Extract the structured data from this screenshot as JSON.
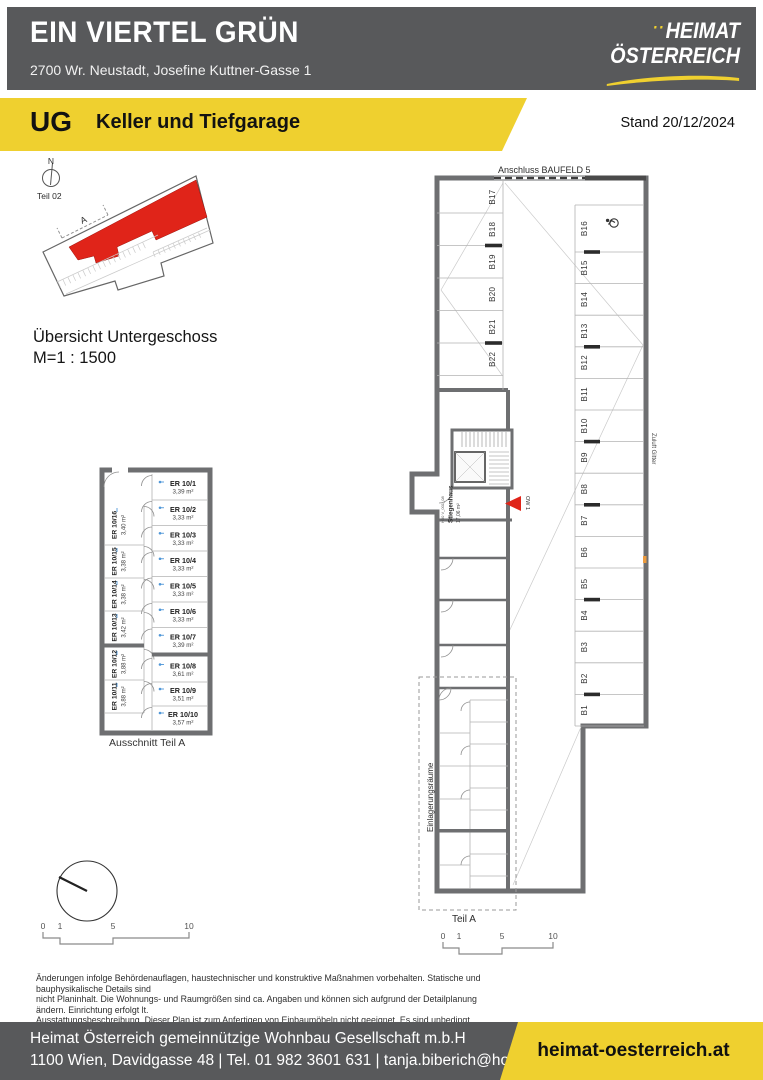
{
  "header": {
    "title": "EIN VIERTEL GRÜN",
    "address": "2700 Wr. Neustadt, Josefine Kuttner-Gasse 1",
    "logo": {
      "dots": "··",
      "line1": "HEIMAT",
      "line2": "ÖSTERREICH"
    }
  },
  "banner": {
    "level": "UG",
    "title": "Keller und Tiefgarage",
    "stand": "Stand 20/12/2024"
  },
  "overview": {
    "north": "N",
    "part": "Teil 02",
    "marker": "A",
    "caption1": "Übersicht Untergeschoss",
    "caption2": "M=1 : 1500"
  },
  "detail": {
    "caption": "Ausschnitt Teil A",
    "rooms_right": [
      {
        "id": "ER 10/1",
        "area": "3,39 m²"
      },
      {
        "id": "ER 10/2",
        "area": "3,33 m²"
      },
      {
        "id": "ER 10/3",
        "area": "3,33 m²"
      },
      {
        "id": "ER 10/4",
        "area": "3,33 m²"
      },
      {
        "id": "ER 10/5",
        "area": "3,33 m²"
      },
      {
        "id": "ER 10/6",
        "area": "3,33 m²"
      },
      {
        "id": "ER 10/7",
        "area": "3,39 m²"
      },
      {
        "id": "ER 10/8",
        "area": "3,61 m²"
      },
      {
        "id": "ER 10/9",
        "area": "3,51 m²"
      },
      {
        "id": "ER 10/10",
        "area": "3,57 m²"
      }
    ],
    "rooms_left": [
      {
        "id": "ER 10/16",
        "area": "3,40 m²"
      },
      {
        "id": "ER 10/15",
        "area": "3,38 m²"
      },
      {
        "id": "ER 10/14",
        "area": "3,38 m²"
      },
      {
        "id": "ER 10/13",
        "area": "3,42 m²"
      },
      {
        "id": "ER 10/12",
        "area": "3,88 m²"
      },
      {
        "id": "ER 10/11",
        "area": "3,88 m²"
      }
    ]
  },
  "main_plan": {
    "top_label": "Anschluss BAUFELD 5",
    "right_label": "Zuluft Gitter",
    "storage_label": "Einlagerungsräume",
    "part_label": "Teil A",
    "stair_code": "H30 V_001_08",
    "stair_name": "Stiegenhaus",
    "stair_area": "17,06 m²",
    "marker": "OW 1",
    "parking_left": [
      "B17",
      "B18",
      "B19",
      "B20",
      "B21",
      "B22"
    ],
    "parking_right": [
      "B16",
      "B15",
      "B14",
      "B13",
      "B12",
      "B11",
      "B10",
      "B9",
      "B8",
      "B7",
      "B6",
      "B5",
      "B4",
      "B3",
      "B2",
      "B1"
    ]
  },
  "scalebar": {
    "t0": "0",
    "t1": "1",
    "t2": "5",
    "t3": "10"
  },
  "disclaimer": {
    "line1": "Änderungen infolge Behördenauflagen, haustechnischer und konstruktive Maßnahmen vorbehalten. Statische und bauphysikalische Details sind",
    "line2": "nicht Planinhalt. Die Wohnungs- und Raumgrößen sind ca. Angaben und können sich aufgrund der Detailplanung ändern. Einrichtung erfolgt lt.",
    "line3": "Ausstattungsbeschreibung. Dieser Plan ist zum Anfertigen von Einbaumöbeln nicht geeignet. Es sind unbedingt Naturmaße zu nehmen !"
  },
  "footer": {
    "company": "Heimat Österreich gemeinnützige Wohnbau Gesellschaft m.b.H",
    "contact": "1100 Wien, Davidgasse 48 | Tel. 01 982 3601 631 | tanja.biberich@hoe.at",
    "website": "heimat-oesterreich.at"
  },
  "colors": {
    "yellow": "#EFD02F",
    "gray": "#58595B",
    "red": "#E02419",
    "wall": "#6E6F71"
  }
}
